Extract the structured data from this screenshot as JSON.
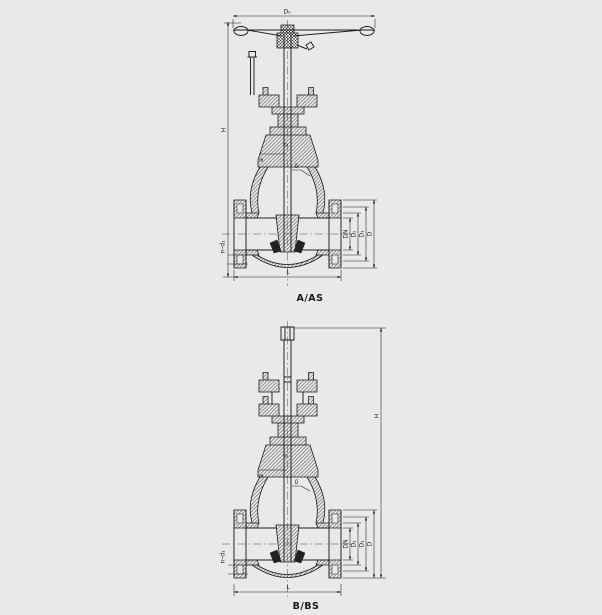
{
  "page": {
    "background_color": "#e9e9e9",
    "line_color": "#1d1d1d"
  },
  "drawing": {
    "type": "gate-valve-sectional-drawings",
    "figure_a": {
      "caption": "A/AS",
      "labels": {
        "handwheel_od": "D₀",
        "height": "H",
        "stem_diameter": "d",
        "dim_a": "a",
        "wall_thickness": "δ",
        "nominal_bore": "DN",
        "dim_d2": "D₂",
        "bolt_circle": "D₁",
        "flange_od": "D",
        "bolt_holes": "n–d₁",
        "face_to_face": "L"
      }
    },
    "figure_b": {
      "caption": "B/BS",
      "labels": {
        "height": "H",
        "stem_diameter": "d",
        "dim_a": "a",
        "wall_thickness": "δ",
        "nominal_bore": "DN",
        "dim_d2": "D₂",
        "bolt_circle": "D₁",
        "flange_od": "D",
        "bolt_holes": "n–d₁",
        "face_to_face": "L"
      }
    }
  }
}
